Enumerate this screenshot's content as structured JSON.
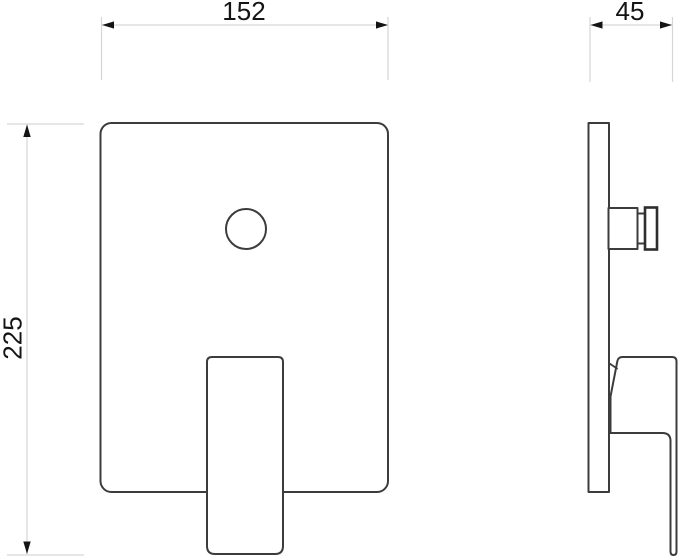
{
  "drawing": {
    "type": "technical-dimension-drawing",
    "subject": "concealed-shower-mixer-front-and-side-view",
    "labels": {
      "width": "152",
      "depth": "45",
      "height": "225"
    },
    "colors": {
      "outline": "#3c3c3c",
      "dimension_line": "#d6d6d6",
      "arrowhead": "#141414",
      "text": "#141414",
      "background": "#ffffff"
    }
  }
}
